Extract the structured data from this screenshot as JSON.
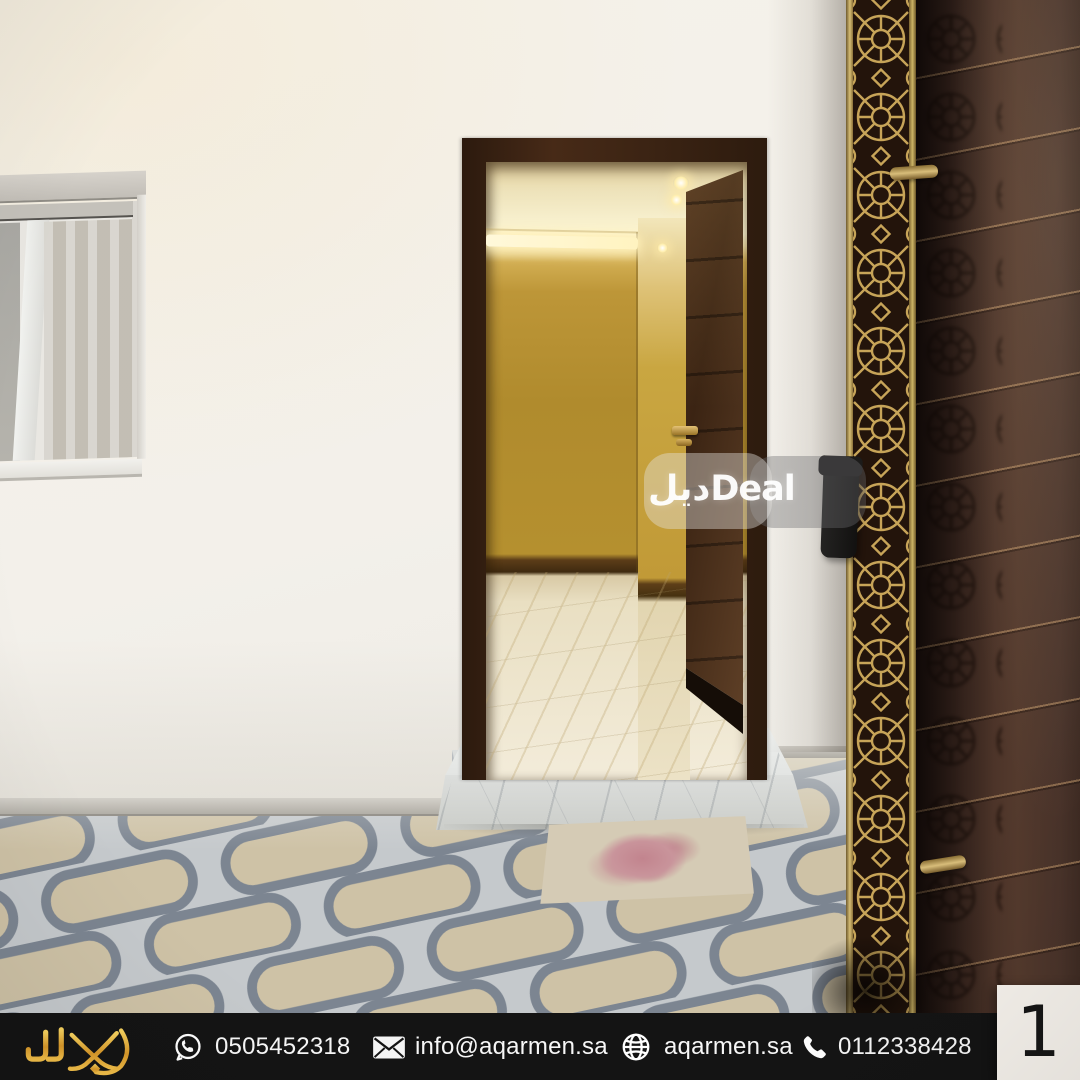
{
  "watermark": {
    "text": "ديلDeal"
  },
  "footer": {
    "contacts": [
      {
        "icon": "whatsapp-icon",
        "value": "0505452318"
      },
      {
        "icon": "email-icon",
        "value": "info@aqarmen.sa"
      },
      {
        "icon": "globe-icon",
        "value": "aqarmen.sa"
      },
      {
        "icon": "phone-icon",
        "value": "0112338428"
      }
    ]
  },
  "page_indicator": {
    "number": "1"
  },
  "scene": {
    "colors": {
      "exterior_wall": "#f3f0ea",
      "door_frame": "#3a2313",
      "interior_wall_gold": "#b5902f",
      "interior_glow": "#fdf6d2",
      "exterior_door_brown": "#432d24",
      "lattice_gold": "#c7a458",
      "tile_background": "#c5c9cc",
      "tile_pill": "#cec2a6",
      "tile_border": "#7c8591",
      "marble_step": "#e3e5e3",
      "rose_mat_pink": "#c2848e",
      "footer_background": "#141414",
      "brand_gold": "#e9b23c",
      "page_box": "#f6f2ec"
    }
  }
}
